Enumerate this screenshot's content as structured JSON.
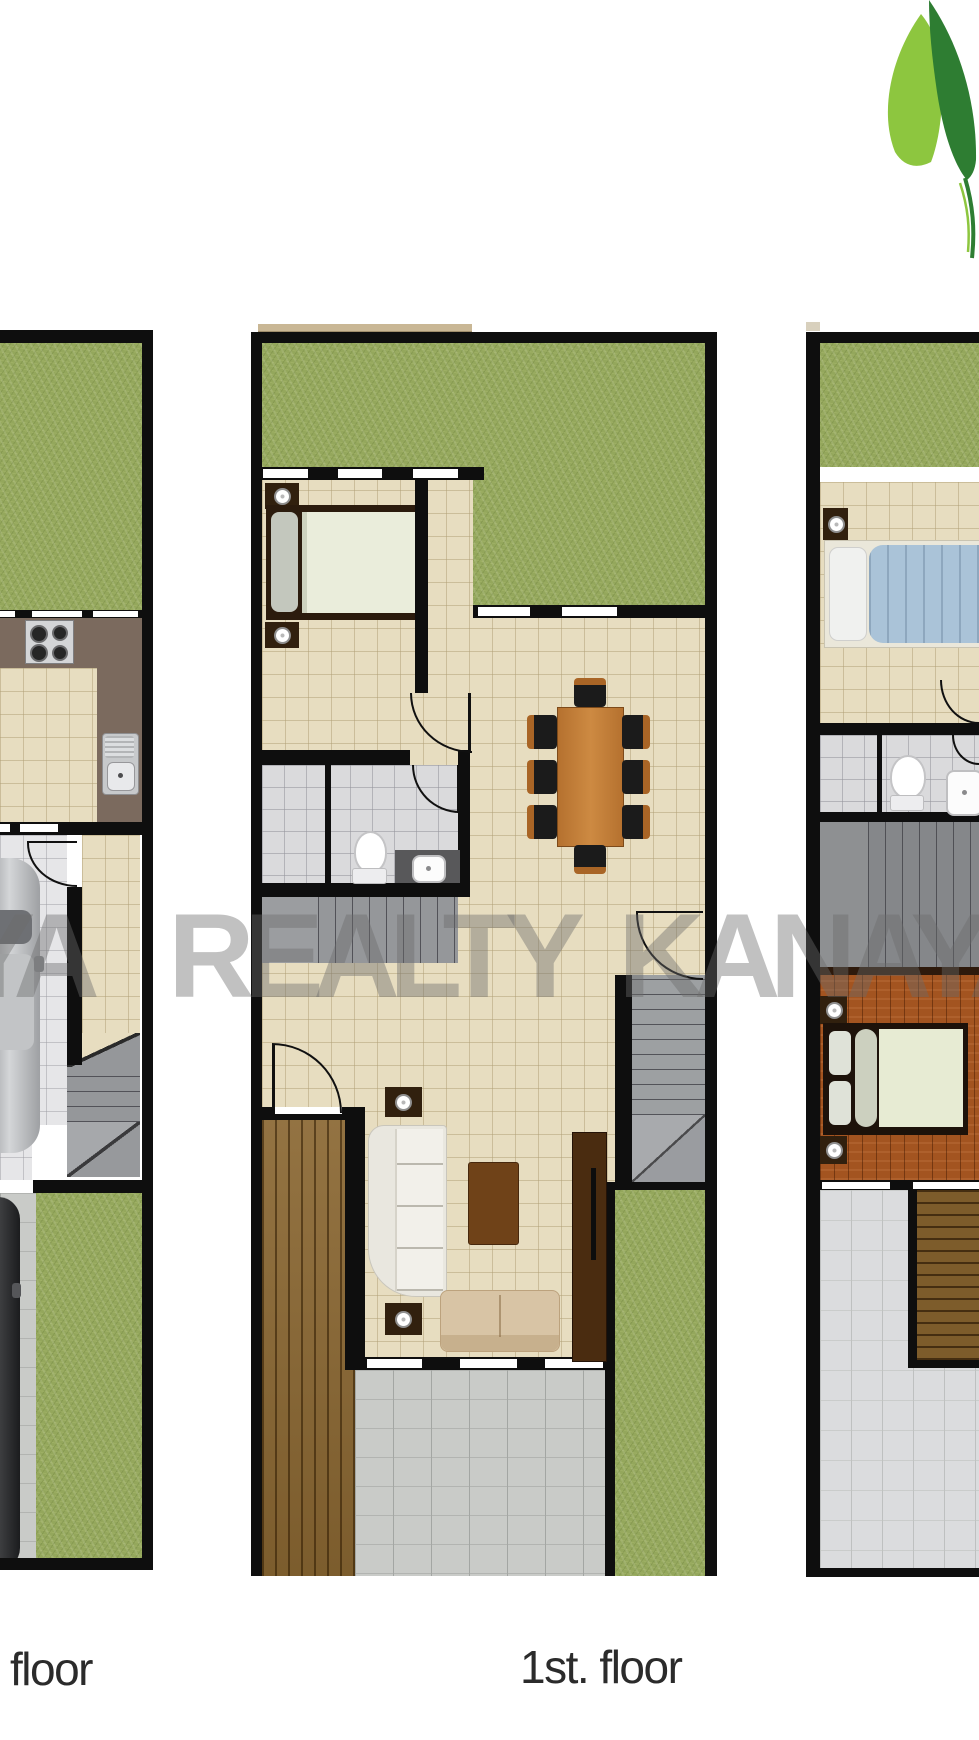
{
  "captions": {
    "left_plan": "floor",
    "middle_plan": "1st. floor"
  },
  "watermark": {
    "part1": "YA",
    "part2": "REALTY",
    "part3": "KANAYA",
    "color": "#6c6c6c"
  },
  "logo": {
    "name": "leaf-logo",
    "light_green": "#8dc63f",
    "dark_green": "#2e7d32"
  },
  "palette": {
    "wall": "#0e0e0e",
    "grass": "#94a75c",
    "tile_beige": "#e7ddc0",
    "tile_gray": "#dadadc",
    "wood_deck": "#8a6732",
    "wood_floor": "#a35420",
    "dining_table": "#c8803d",
    "caption_text": "#2b2b2b"
  }
}
